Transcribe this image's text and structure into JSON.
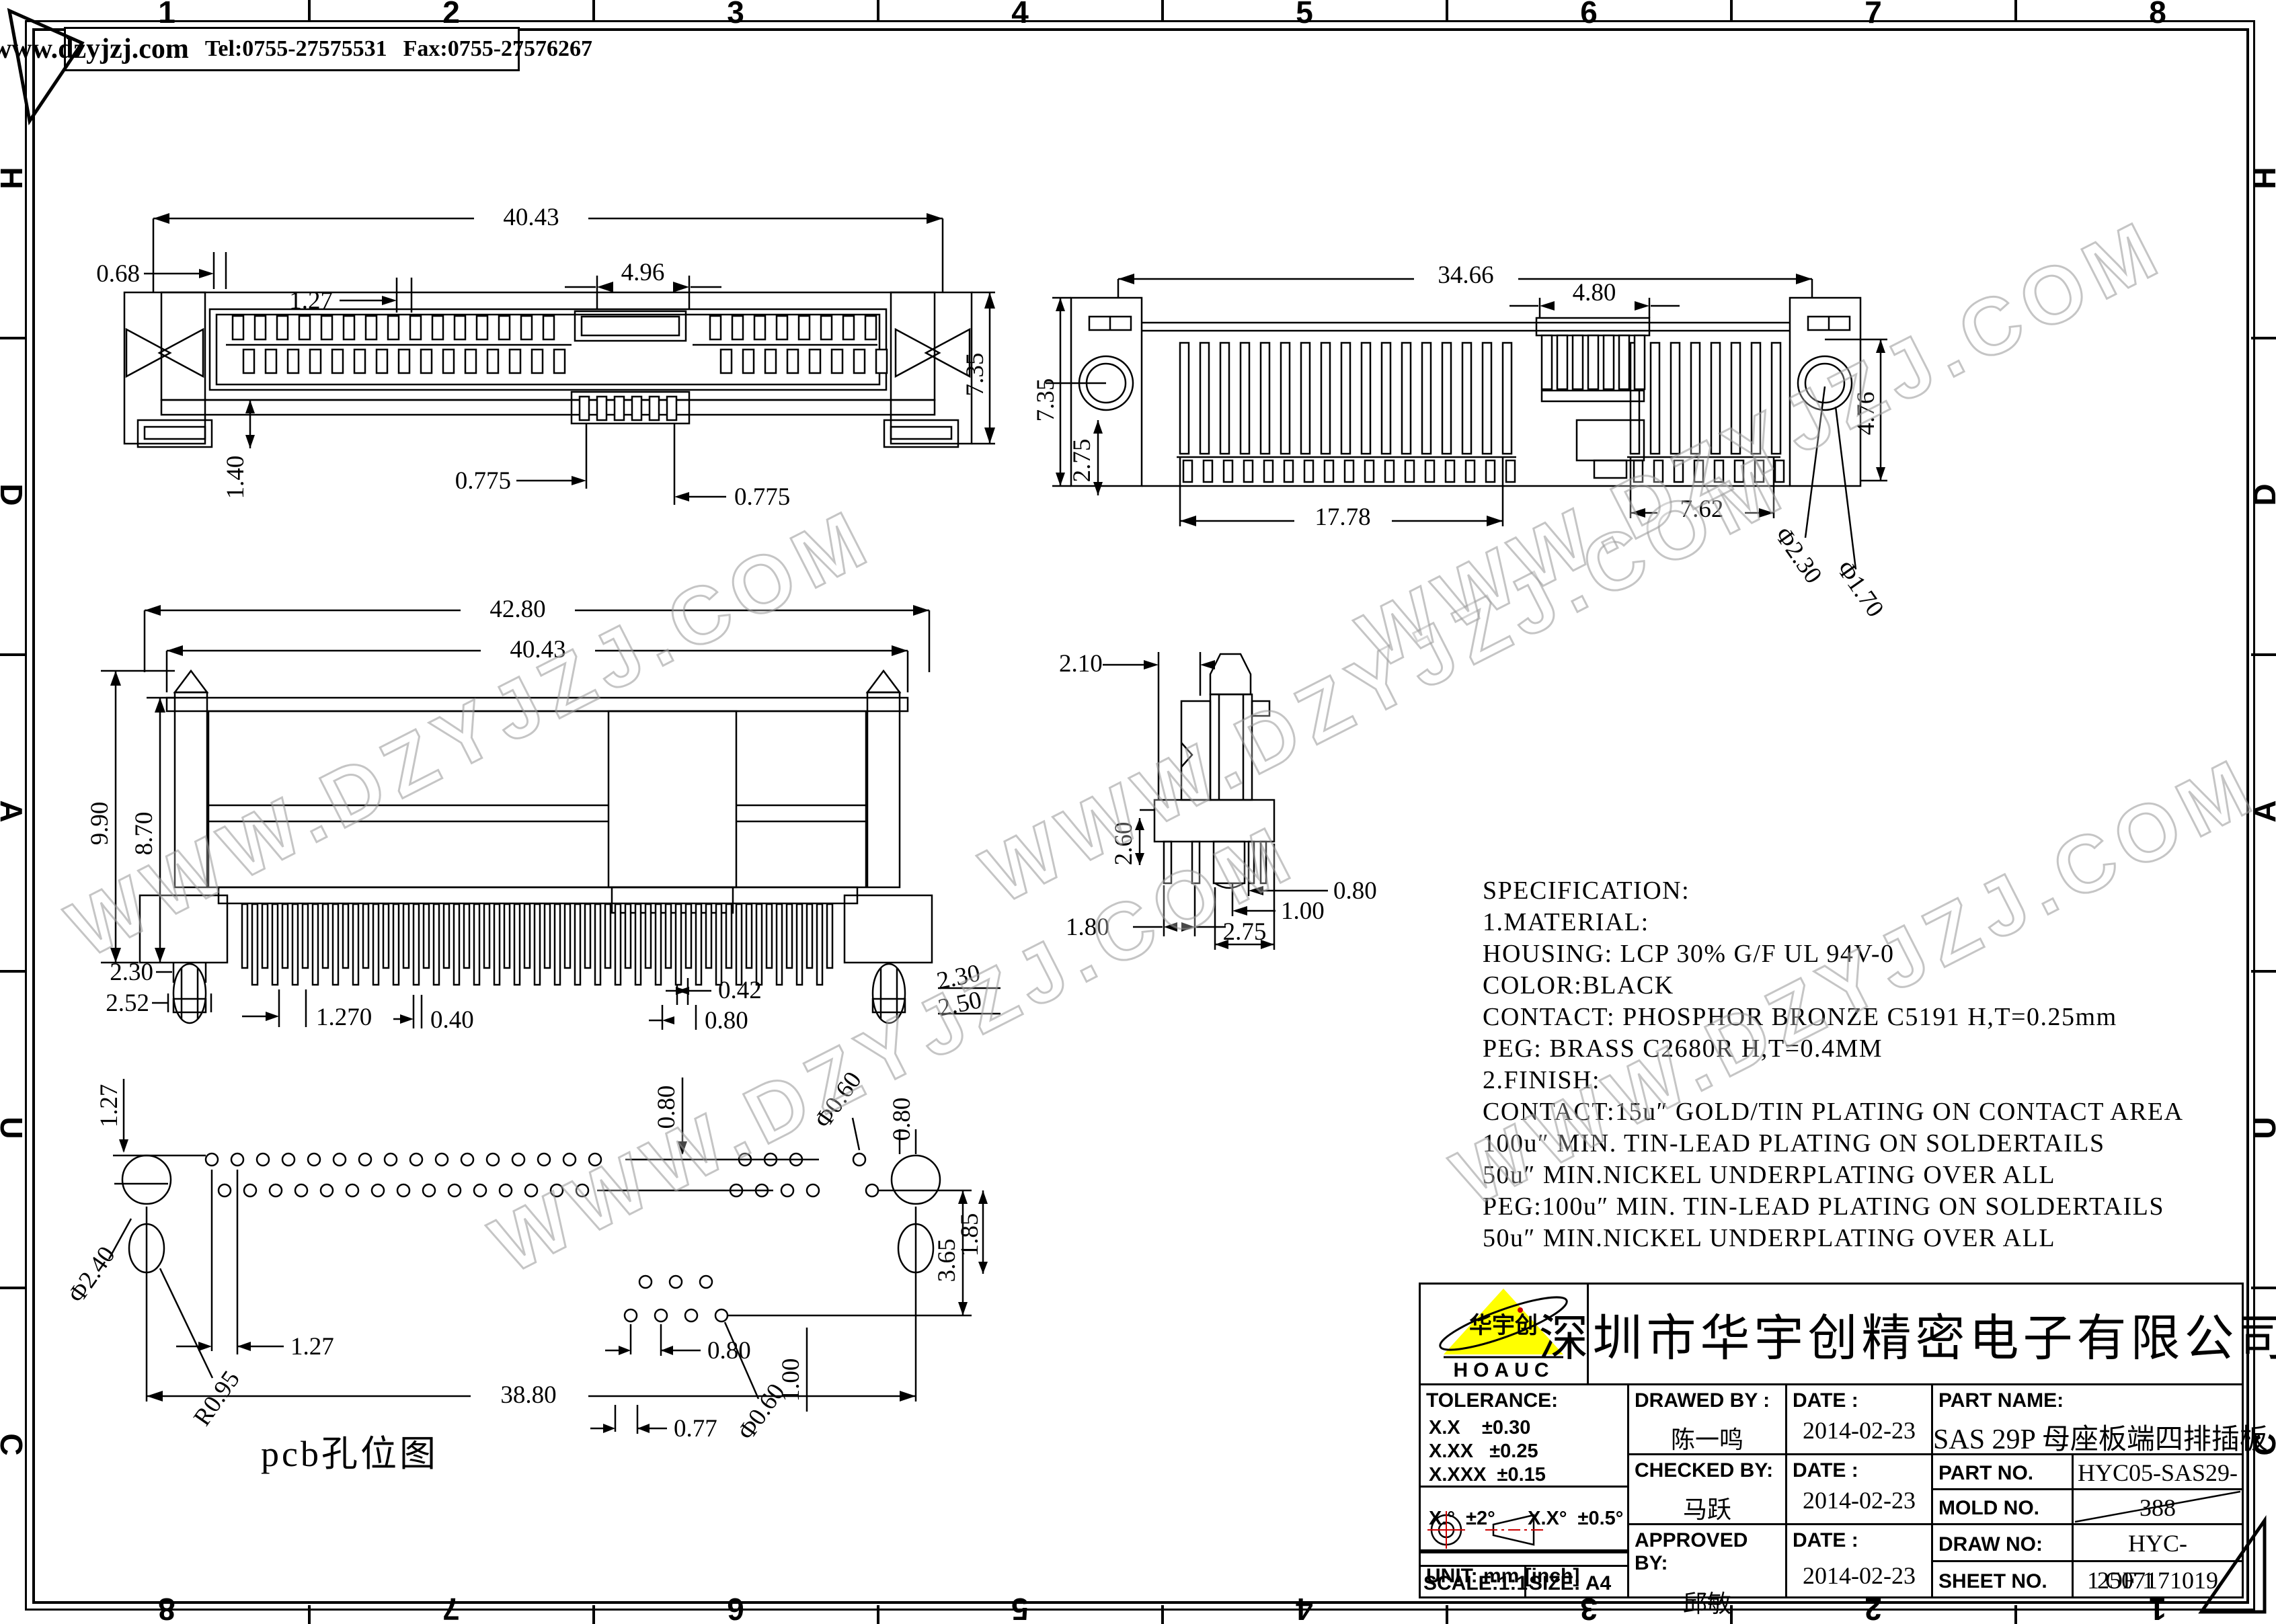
{
  "frame": {
    "website_box": {
      "site": "www.dzyjzj.com",
      "tel": "Tel:0755-27575531",
      "fax": "Fax:0755-27576267"
    },
    "zones_top": [
      "1",
      "2",
      "3",
      "4",
      "5",
      "6",
      "7",
      "8"
    ],
    "zones_bottom": [
      "8",
      "7",
      "6",
      "5",
      "4",
      "3",
      "2",
      "1"
    ],
    "zones_left": [
      "H",
      "D",
      "A",
      "U",
      "C"
    ],
    "zones_right": [
      "H",
      "D",
      "A",
      "U",
      "C"
    ]
  },
  "watermark": {
    "text": "WWW.DZYJZJ.COM"
  },
  "views": {
    "front": {
      "dims": {
        "overall": "40.43",
        "offset": "0.68",
        "pitch": "1.27",
        "key_width": "4.96",
        "height": "7.35",
        "leg": "1.40",
        "slot_left": "0.775",
        "slot_right": "0.775"
      }
    },
    "rear": {
      "dims": {
        "overall": "34.66",
        "key_width": "4.80",
        "height": "7.35",
        "tail": "2.75",
        "span_left": "17.78",
        "span_right": "7.62",
        "right_height": "4.76",
        "hole_outer": "Φ2.30",
        "hole_inner": "Φ1.70"
      }
    },
    "side": {
      "dims": {
        "overall": "42.80",
        "body": "40.43",
        "height": "9.90",
        "body_height": "8.70",
        "peg_left_top": "2.30",
        "peg_left_bottom": "2.52",
        "pin_pitch": "1.270",
        "pin_width": "0.40",
        "pin_width_b": "0.42",
        "pin_gap": "0.80",
        "peg_right_top": "2.30",
        "peg_right_bottom": "2.50"
      }
    },
    "end": {
      "dims": {
        "cap": "2.10",
        "tail": "2.60",
        "offset": "1.80",
        "pin": "0.80",
        "pitch": "1.00",
        "span": "2.75"
      }
    },
    "pcb": {
      "caption": "pcb孔位图",
      "dims": {
        "row_offset": "1.27",
        "col_top": "0.80",
        "hole_top": "Φ0.60",
        "hole_gap": "0.80",
        "big_hole": "Φ2.40",
        "corner_radius": "R0.95",
        "pitch": "1.27",
        "gap_mid": "0.80",
        "overall": "38.80",
        "offset_bottom": "0.77",
        "hole_bottom": "Φ0.60",
        "pitch_b": "1.00",
        "span_right": "3.65",
        "span_right_b": "1.85"
      }
    }
  },
  "specification": {
    "lines": [
      "SPECIFICATION:",
      "1.MATERIAL:",
      "HOUSING: LCP 30% G/F UL 94V-0",
      "COLOR:BLACK",
      "CONTACT: PHOSPHOR BRONZE C5191 H,T=0.25mm",
      "PEG: BRASS C2680R H,T=0.4MM",
      "2.FINISH:",
      "CONTACT:15u″ GOLD/TIN PLATING ON CONTACT AREA",
      "100u″ MIN.  TIN-LEAD PLATING ON SOLDERTAILS",
      "50u″ MIN.NICKEL UNDERPLATING OVER ALL",
      "PEG:100u″ MIN.  TIN-LEAD PLATING ON SOLDERTAILS",
      "50u″ MIN.NICKEL UNDERPLATING OVER ALL"
    ]
  },
  "title_block": {
    "logo": {
      "brand": "华宇创",
      "sub": "HOAUC",
      "triangle_color": "#ffff00"
    },
    "company": "深圳市华宇创精密电子有限公司",
    "tolerance": {
      "label": "TOLERANCE:",
      "rows": [
        "X.X    ±0.30",
        "X.XX   ±0.25",
        "X.XXX  ±0.15"
      ],
      "angles": "X.°  ±2°      X.X°  ±0.5°"
    },
    "unit": "UNIT:  mm  [inch]",
    "scale": "SCALE:1:1",
    "size": "SIZE:  A4",
    "drawed_by": {
      "label": "DRAWED BY :",
      "value": "陈一鸣"
    },
    "checked_by": {
      "label": "CHECKED BY:",
      "value": "马跃"
    },
    "approved_by": {
      "label": "APPROVED BY:",
      "value": "邱敏"
    },
    "date_label": "DATE :",
    "dates": [
      "2014-02-23",
      "2014-02-23",
      "2014-02-23"
    ],
    "part_name": {
      "label": "PART NAME:",
      "value": "SAS 29P 母座板端四排插板"
    },
    "part_no": {
      "label": "PART NO.",
      "value": "HYC05-SAS29-388"
    },
    "mold_no": {
      "label": "MOLD NO.",
      "value": ""
    },
    "draw_no": {
      "label": "DRAW NO:",
      "value": "HYC-2507171019"
    },
    "sheet_no": {
      "label": "SHEET NO.",
      "value": "1 OF 1"
    }
  }
}
